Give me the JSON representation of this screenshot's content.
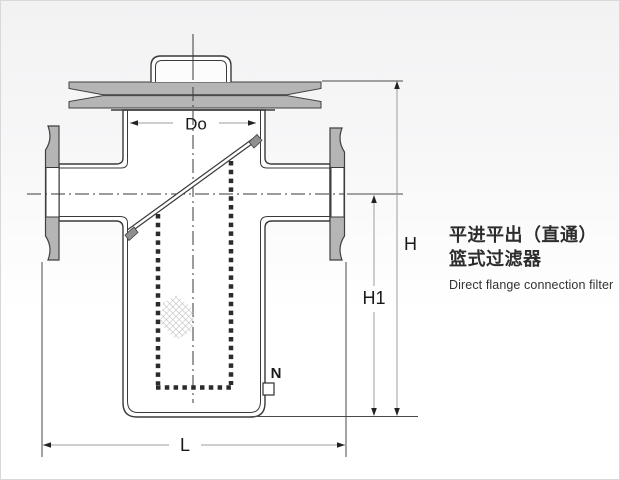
{
  "title": {
    "line1_zh": "平进平出（直通）",
    "line2_zh": "篮式过滤器",
    "line_en": "Direct flange connection filter"
  },
  "drawing": {
    "type": "technical-cross-section",
    "subject": "basket strainer, flanged inline body",
    "dimension_labels": {
      "basket_diameter": "Do",
      "overall_height": "H",
      "lower_height": "H1",
      "face_to_face_length": "L",
      "drain_port": "N"
    }
  },
  "colors": {
    "metal_fill": "#b5b5b5",
    "outline": "#3a3a3a",
    "dimension_line": "#9c9c9c",
    "arrowhead": "#222222",
    "label": "#1a1a1a",
    "background_top": "#f2f2f3",
    "background_bottom": "#ffffff"
  }
}
